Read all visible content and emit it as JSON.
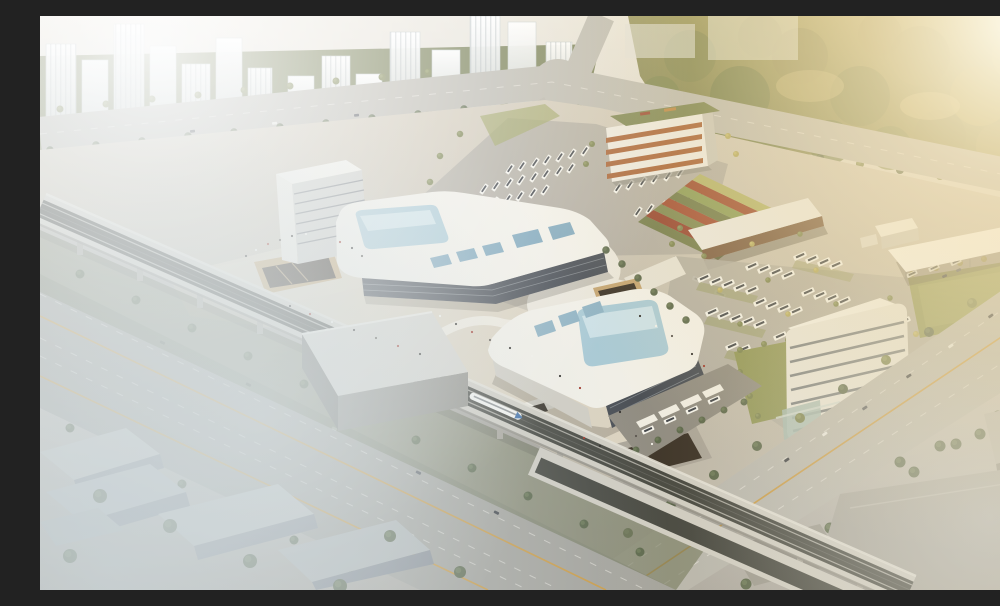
{
  "scene": {
    "title": "Aerial architectural rendering of a modern transit hub complex",
    "setting": "daytime bird's-eye view with golden sunlight from the upper right, haze over distant towers and fog in the lower left",
    "elements": {
      "residential_towers": "faded white high-rise apartment towers among trees, upper left",
      "forest_park": "large sunlit woodland, upper right",
      "main_terminal": "white curved-roof terminal building with large pale-blue skylight and attached office tower",
      "south_terminal": "second curved white building with blue glass skylight and dark glass facade",
      "office_building_north": "mid-rise block with orange spandrel bands and planted green roof",
      "office_building_east": "white slab building with horizontal ribbon windows and glass lobby",
      "bus_depots": "two large parking yards filled with rows of white coaches",
      "bus_shelter_shed": "long open-sided shed with timber-toned underside",
      "white_canopy": "flat white canopy on slender columns over vehicles",
      "terraced_planting": "diagonal red and green planted terraces beside the plaza",
      "elevated_railway": "rail viaduct crossing the site diagonally with a white high-speed train and a gray station box over the tracks",
      "highway": "wide multi-lane road parallel to the viaduct, lower left",
      "arterial_road": "broad avenue with yellow center line, lower right",
      "sunken_courtyards": "tan-walled sunken plazas with escalators",
      "pedestrian_plaza": "beige esplanade dotted with tiny pedestrians",
      "industrial_sheds": "fog-covered gray warehouses, lower corners"
    },
    "vehicles": {
      "train_count": 1,
      "bus_style": "white body with dark window band",
      "car_colors": [
        "dark gray",
        "white",
        "blue"
      ]
    },
    "lighting": {
      "sun_position": "upper right",
      "effects": [
        "golden flare",
        "white haze upper left",
        "ground fog lower left"
      ]
    }
  },
  "palette": {
    "roof": "#f1efe7",
    "roofshade": "#d7d3c7",
    "wallshade": "#c8c5ba",
    "glassdark": "#474c53",
    "skylight": "#a9c9d4",
    "skysheen": "#d4e6ea",
    "plaza": "#dbd2bf",
    "asphalt": "#aeaaa0",
    "road": "#b8b6ad",
    "grass": "#8c9254",
    "grasslight": "#9aa05e",
    "treedark": "#5a664a",
    "treeolive": "#79814f",
    "treegold": "#b1a65e",
    "deck": "#cfccc2",
    "track": "#45463f",
    "pier": "#a7a399",
    "white": "#f4f3ee",
    "orange": "#a65f33",
    "shedwood": "#77573d",
    "courtwall": "#c2a26f",
    "courtdark": "#3a3126",
    "yellowline": "#c99a45",
    "busbody": "#f2f1ea",
    "buswindow": "#3e4248",
    "trainblue": "#3f6fa8",
    "haze": "#ffffff",
    "sunflare": "#fff3d2",
    "fog": "#d2dce0"
  }
}
